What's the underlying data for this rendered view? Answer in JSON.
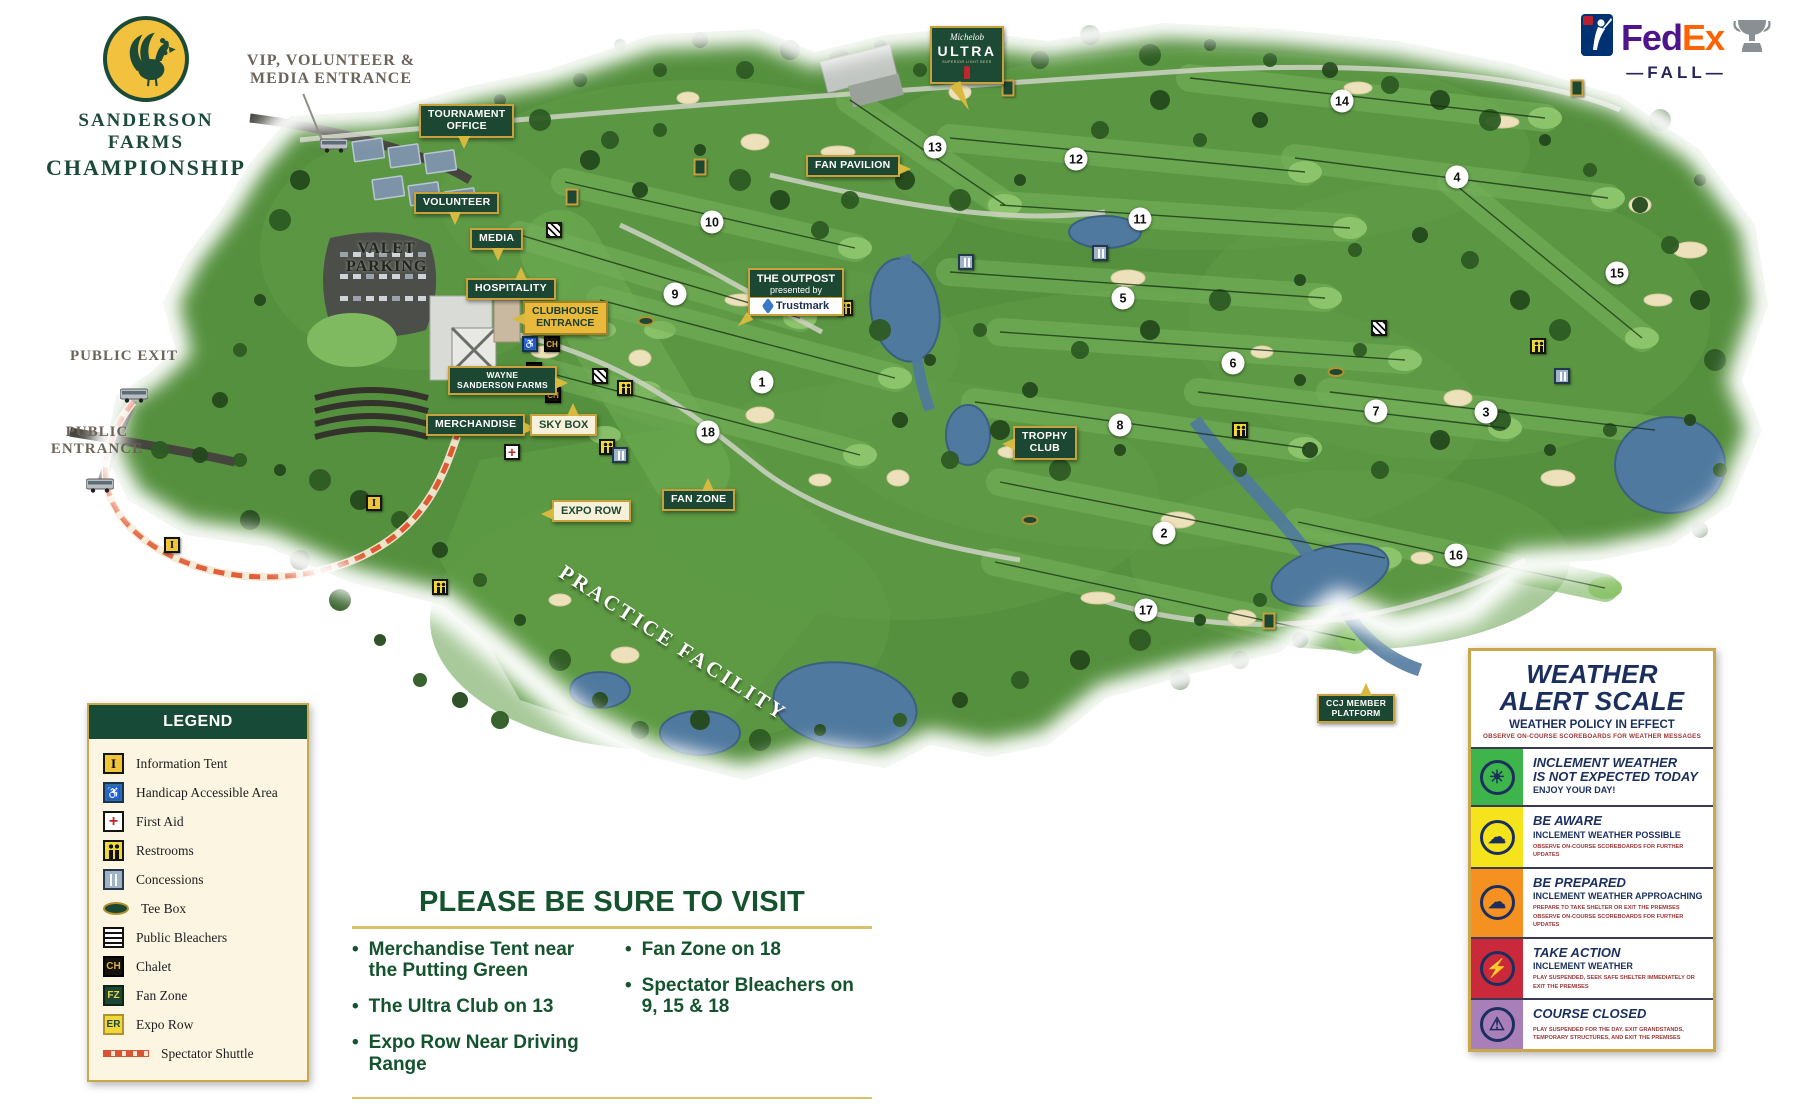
{
  "branding": {
    "title_line1": "SANDERSON FARMS",
    "title_line2": "CHAMPIONSHIP",
    "fedex_fed": "Fed",
    "fedex_ex": "Ex",
    "fedex_fall": "—FALL—"
  },
  "entrances": {
    "vip": "VIP, VOLUNTEER &\nMEDIA ENTRANCE",
    "public_exit": "PUBLIC EXIT",
    "public_entrance": "PUBLIC\nENTRANCE"
  },
  "map": {
    "valet": "VALET\nPARKING",
    "practice_facility": "PRACTICE FACILITY",
    "outpost": {
      "title": "THE OUTPOST",
      "presented": "presented by",
      "brand": "Trustmark"
    },
    "ultra": {
      "script": "Michelob",
      "name": "ULTRA",
      "tagline": "SUPERIOR LIGHT BEER"
    },
    "labels": [
      {
        "text": "TOURNAMENT\nOFFICE",
        "style": "green",
        "tail": "down",
        "x": 419,
        "y": 104
      },
      {
        "text": "VOLUNTEER",
        "style": "green",
        "tail": "down",
        "x": 414,
        "y": 192
      },
      {
        "text": "MEDIA",
        "style": "green",
        "tail": "down",
        "x": 470,
        "y": 228
      },
      {
        "text": "HOSPITALITY",
        "style": "green",
        "tail": "up",
        "x": 466,
        "y": 278
      },
      {
        "text": "CLUBHOUSE\nENTRANCE",
        "style": "gold",
        "tail": "left",
        "x": 523,
        "y": 301
      },
      {
        "text": "WAYNE\nSANDERSON FARMS",
        "style": "green",
        "small": true,
        "tail": "right",
        "x": 448,
        "y": 366
      },
      {
        "text": "MERCHANDISE",
        "style": "green",
        "tail": "right",
        "x": 426,
        "y": 414
      },
      {
        "text": "SKY BOX",
        "style": "cream",
        "tail": "up",
        "x": 530,
        "y": 414
      },
      {
        "text": "EXPO ROW",
        "style": "cream",
        "tail": "left",
        "x": 552,
        "y": 500
      },
      {
        "text": "FAN ZONE",
        "style": "green",
        "tail": "up",
        "x": 662,
        "y": 489
      },
      {
        "text": "FAN PAVILION",
        "style": "green",
        "tail": "right",
        "x": 806,
        "y": 155
      },
      {
        "text": "TROPHY\nCLUB",
        "style": "green",
        "tail": "left",
        "x": 1013,
        "y": 426
      },
      {
        "text": "CCJ MEMBER\nPLATFORM",
        "style": "green",
        "small": true,
        "tail": "up",
        "x": 1317,
        "y": 694
      }
    ],
    "holes": [
      {
        "num": "1",
        "x": 762,
        "y": 382
      },
      {
        "num": "2",
        "x": 1164,
        "y": 533
      },
      {
        "num": "3",
        "x": 1486,
        "y": 412
      },
      {
        "num": "4",
        "x": 1457,
        "y": 177
      },
      {
        "num": "5",
        "x": 1123,
        "y": 298
      },
      {
        "num": "6",
        "x": 1233,
        "y": 363
      },
      {
        "num": "7",
        "x": 1376,
        "y": 411
      },
      {
        "num": "8",
        "x": 1120,
        "y": 425
      },
      {
        "num": "9",
        "x": 675,
        "y": 294
      },
      {
        "num": "10",
        "x": 712,
        "y": 222
      },
      {
        "num": "11",
        "x": 1140,
        "y": 219
      },
      {
        "num": "12",
        "x": 1076,
        "y": 159
      },
      {
        "num": "13",
        "x": 935,
        "y": 147
      },
      {
        "num": "14",
        "x": 1342,
        "y": 101
      },
      {
        "num": "15",
        "x": 1617,
        "y": 273
      },
      {
        "num": "16",
        "x": 1456,
        "y": 555
      },
      {
        "num": "17",
        "x": 1146,
        "y": 610
      },
      {
        "num": "18",
        "x": 708,
        "y": 432
      }
    ],
    "icons": [
      {
        "type": "bleachers",
        "x": 554,
        "y": 230
      },
      {
        "type": "bleachers",
        "x": 600,
        "y": 376
      },
      {
        "type": "bleachers",
        "x": 1379,
        "y": 328
      },
      {
        "type": "restrooms",
        "x": 625,
        "y": 388
      },
      {
        "type": "restrooms",
        "x": 607,
        "y": 447
      },
      {
        "type": "restrooms",
        "x": 440,
        "y": 587
      },
      {
        "type": "restrooms",
        "x": 845,
        "y": 308
      },
      {
        "type": "restrooms",
        "x": 1538,
        "y": 346
      },
      {
        "type": "restrooms",
        "x": 1240,
        "y": 430
      },
      {
        "type": "concessions",
        "x": 620,
        "y": 455
      },
      {
        "type": "concessions",
        "x": 1100,
        "y": 253
      },
      {
        "type": "concessions",
        "x": 1562,
        "y": 376
      },
      {
        "type": "concessions",
        "x": 966,
        "y": 262
      },
      {
        "type": "chalet",
        "badge": "CH",
        "x": 552,
        "y": 344
      },
      {
        "type": "chalet",
        "badge": "CH",
        "x": 534,
        "y": 370
      },
      {
        "type": "chalet",
        "badge": "CH",
        "x": 553,
        "y": 395
      },
      {
        "type": "handicap",
        "badge": "♿",
        "x": 530,
        "y": 344
      },
      {
        "type": "firstaid",
        "badge": "+",
        "x": 512,
        "y": 452
      },
      {
        "type": "infotent",
        "badge": "I",
        "x": 172,
        "y": 545
      },
      {
        "type": "infotent",
        "badge": "I",
        "x": 374,
        "y": 503
      },
      {
        "type": "teesign",
        "x": 572,
        "y": 197
      },
      {
        "type": "teesign",
        "x": 1008,
        "y": 88
      },
      {
        "type": "teesign",
        "x": 1577,
        "y": 88
      },
      {
        "type": "teesign",
        "x": 1269,
        "y": 621
      },
      {
        "type": "teesign",
        "x": 700,
        "y": 167
      },
      {
        "type": "teeoval",
        "x": 646,
        "y": 321
      },
      {
        "type": "teeoval",
        "x": 1336,
        "y": 372
      },
      {
        "type": "teeoval",
        "x": 1030,
        "y": 520
      }
    ]
  },
  "legend": {
    "title": "LEGEND",
    "items": [
      {
        "icon": "infotent",
        "badge": "I",
        "label": "Information Tent"
      },
      {
        "icon": "handicap",
        "badge": "♿",
        "label": "Handicap Accessible Area"
      },
      {
        "icon": "firstaid",
        "badge": "+",
        "label": "First Aid"
      },
      {
        "icon": "restrooms",
        "badge": "",
        "label": "Restrooms"
      },
      {
        "icon": "concessions",
        "badge": "",
        "label": "Concessions"
      },
      {
        "icon": "teebox",
        "badge": "",
        "label": "Tee Box"
      },
      {
        "icon": "bleachers",
        "badge": "",
        "label": "Public Bleachers"
      },
      {
        "icon": "chalet",
        "badge": "CH",
        "label": "Chalet"
      },
      {
        "icon": "fanzone",
        "badge": "FZ",
        "label": "Fan Zone"
      },
      {
        "icon": "exporow",
        "badge": "ER",
        "label": "Expo Row"
      },
      {
        "icon": "shuttle",
        "badge": "",
        "label": "Spectator Shuttle"
      }
    ]
  },
  "visit": {
    "title": "PLEASE BE SURE TO VISIT",
    "bullet": "•",
    "left": [
      "Merchandise Tent near the Putting Green",
      "The Ultra Club on 13",
      "Expo Row Near Driving Range"
    ],
    "right": [
      "Fan Zone on 18",
      "Spectator Bleachers on 9, 15 & 18"
    ]
  },
  "weather": {
    "title": "WEATHER\nALERT SCALE",
    "subtitle": "WEATHER POLICY IN EFFECT",
    "note": "OBSERVE ON-COURSE SCOREBOARDS FOR WEATHER MESSAGES",
    "levels": [
      {
        "color": "#3db54a",
        "glyph": "☀",
        "icon": "sun",
        "heading": "INCLEMENT WEATHER\nIS NOT EXPECTED TODAY",
        "subheading": "ENJOY YOUR DAY!",
        "fine": ""
      },
      {
        "color": "#f5e31c",
        "glyph": "☁",
        "icon": "rain-cloud",
        "heading": "BE AWARE",
        "subheading": "INCLEMENT WEATHER POSSIBLE",
        "fine": "OBSERVE ON-COURSE SCOREBOARDS FOR FURTHER UPDATES"
      },
      {
        "color": "#f59120",
        "glyph": "☁",
        "icon": "storm-cloud",
        "heading": "BE PREPARED",
        "subheading": "INCLEMENT WEATHER APPROACHING",
        "fine": "PREPARE TO TAKE SHELTER OR EXIT THE PREMISES\nOBSERVE ON-COURSE SCOREBOARDS FOR FURTHER UPDATES"
      },
      {
        "color": "#c9293a",
        "glyph": "⚡",
        "icon": "severe-weather",
        "heading": "TAKE ACTION",
        "subheading": "INCLEMENT WEATHER",
        "fine": "PLAY SUSPENDED, SEEK SAFE SHELTER IMMEDIATELY OR EXIT THE PREMISES"
      },
      {
        "color": "#a87fb8",
        "glyph": "⚠",
        "icon": "course-closed",
        "heading": "COURSE CLOSED",
        "subheading": "",
        "fine": "PLAY SUSPENDED FOR THE DAY. EXIT GRANDSTANDS,\nTEMPORARY STRUCTURES, AND EXIT THE PREMISES"
      }
    ]
  }
}
